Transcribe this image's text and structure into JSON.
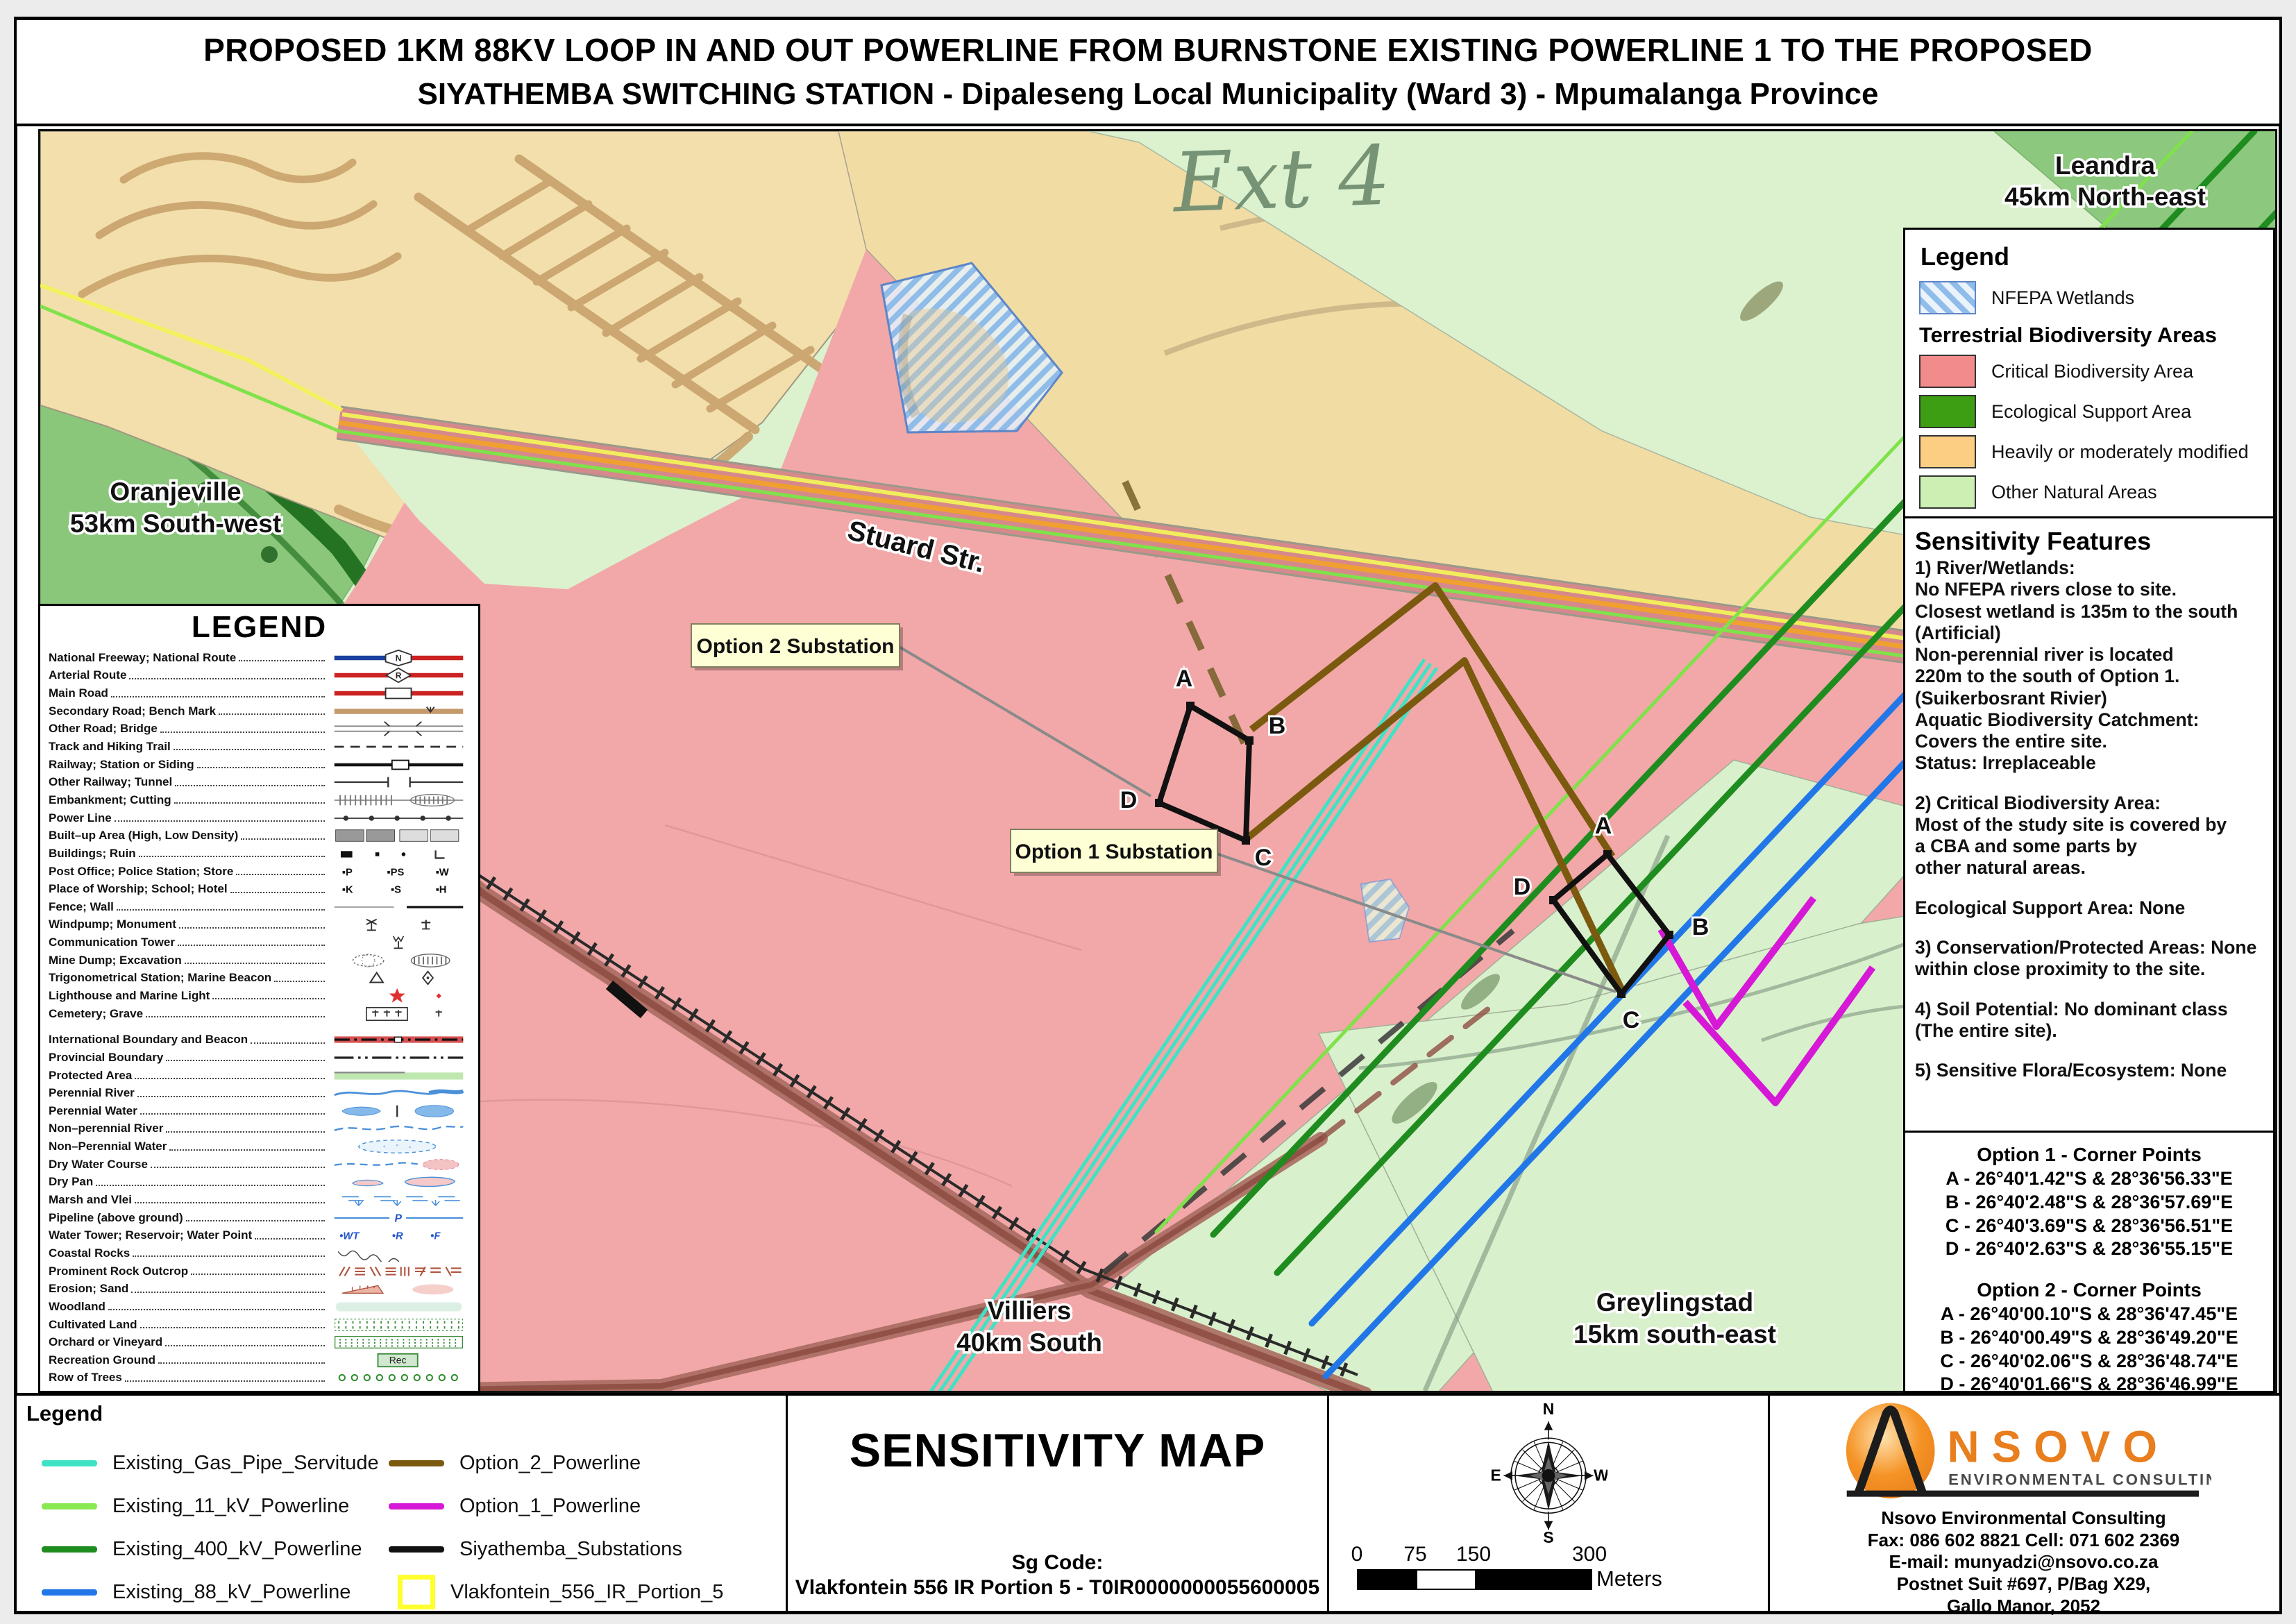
{
  "title": {
    "line1": "PROPOSED 1KM 88KV LOOP IN AND OUT POWERLINE FROM BURNSTONE EXISTING POWERLINE 1 TO THE PROPOSED",
    "line2": "SIYATHEMBA SWITCHING STATION - Dipaleseng Local Municipality (Ward 3) - Mpumalanga Province"
  },
  "map": {
    "labels": {
      "ext4": "Ext 4",
      "leandra": [
        "Leandra",
        "45km North-east"
      ],
      "oranjeville": [
        "Oranjeville",
        "53km South-west"
      ],
      "stuard": "Stuard Str.",
      "villiers": [
        "Villiers",
        "40km South"
      ],
      "greylingstad": [
        "Greylingstad",
        "15km south-east"
      ],
      "option2_box": "Option 2 Substation",
      "option1_box": "Option 1 Substation",
      "corners": [
        "A",
        "B",
        "C",
        "D"
      ]
    }
  },
  "right_legend": {
    "title": "Legend",
    "wetlands": "NFEPA Wetlands",
    "subtitle": "Terrestrial Biodiversity Areas",
    "items": [
      {
        "label": "Critical Biodiversity Area",
        "color": "#F28B8B"
      },
      {
        "label": "Ecological Support Area",
        "color": "#3D9E14"
      },
      {
        "label": "Heavily or moderately modified",
        "color": "#FBCE84"
      },
      {
        "label": "Other Natural Areas",
        "color": "#CDEFB4"
      }
    ]
  },
  "sensitivity": {
    "title": "Sensitivity Features",
    "lines": [
      "1) River/Wetlands:",
      "No NFEPA rivers close to site.",
      "Closest wetland is 135m to the south",
      "(Artificial)",
      "Non-perennial river is located",
      "220m to the south of Option 1.",
      "(Suikerbosrant Rivier)",
      "Aquatic Biodiversity Catchment:",
      "Covers the entire site.",
      "Status: Irreplaceable",
      "",
      "2) Critical Biodiversity Area:",
      "Most of the study site is covered by",
      "a CBA and some parts by",
      " other natural areas.",
      "",
      "Ecological Support Area: None",
      "",
      "3) Conservation/Protected Areas: None",
      "within close proximity to the site.",
      "",
      "4) Soil Potential: No dominant class",
      " (The entire site).",
      "",
      "5) Sensitive Flora/Ecosystem: None"
    ]
  },
  "corner_points": {
    "option1_title": "Option 1 - Corner Points",
    "option1": [
      "A -  26°40'1.42\"S  &  28°36'56.33\"E",
      "B -  26°40'2.48\"S  &  28°36'57.69\"E",
      "C -  26°40'3.69\"S  &  28°36'56.51\"E",
      "D -  26°40'2.63\"S  &  28°36'55.15\"E"
    ],
    "option2_title": "Option 2 - Corner Points",
    "option2": [
      "A -   26°40'00.10\"S  &   28°36'47.45\"E",
      "B -   26°40'00.49\"S  &   28°36'49.20\"E",
      "C -   26°40'02.06\"S  &   28°36'48.74\"E",
      "D -   26°40'01.66\"S  &   28°36'46.99\"E"
    ]
  },
  "map_legend": {
    "title": "LEGEND",
    "items": [
      {
        "label": "National Freeway; National Route",
        "sym": "freeway"
      },
      {
        "label": "Arterial Route",
        "sym": "arterial"
      },
      {
        "label": "Main Road",
        "sym": "main"
      },
      {
        "label": "Secondary Road; Bench Mark",
        "sym": "secondary"
      },
      {
        "label": "Other Road; Bridge",
        "sym": "other_road"
      },
      {
        "label": "Track and Hiking Trail",
        "sym": "track"
      },
      {
        "label": "Railway; Station or Siding",
        "sym": "railway"
      },
      {
        "label": "Other Railway; Tunnel",
        "sym": "other_railway"
      },
      {
        "label": "Embankment; Cutting",
        "sym": "embankment"
      },
      {
        "label": "Power Line",
        "sym": "powerline"
      },
      {
        "label": "Built–up Area (High, Low Density)",
        "sym": "builtup"
      },
      {
        "label": "Buildings; Ruin",
        "sym": "buildings"
      },
      {
        "label": "Post Office; Police Station; Store",
        "sym": "po"
      },
      {
        "label": "Place of Worship; School; Hotel",
        "sym": "worship"
      },
      {
        "label": "Fence; Wall",
        "sym": "fence"
      },
      {
        "label": "Windpump; Monument",
        "sym": "windpump"
      },
      {
        "label": "Communication Tower",
        "sym": "tower"
      },
      {
        "label": "Mine Dump; Excavation",
        "sym": "minedump"
      },
      {
        "label": "Trigonometrical Station; Marine Beacon",
        "sym": "trig"
      },
      {
        "label": "Lighthouse and Marine Light",
        "sym": "lighthouse"
      },
      {
        "label": "Cemetery; Grave",
        "sym": "cemetery"
      },
      {
        "label": "International Boundary and Beacon",
        "sym": "intl",
        "gapBefore": true
      },
      {
        "label": "Provincial Boundary",
        "sym": "prov"
      },
      {
        "label": "Protected Area",
        "sym": "protected"
      },
      {
        "label": "Perennial River",
        "sym": "per_river"
      },
      {
        "label": "Perennial Water",
        "sym": "per_water"
      },
      {
        "label": "Non–perennial River",
        "sym": "nonper_river"
      },
      {
        "label": "Non–Perennial Water",
        "sym": "nonper_water"
      },
      {
        "label": "Dry Water Course",
        "sym": "dry_course"
      },
      {
        "label": "Dry Pan",
        "sym": "dry_pan"
      },
      {
        "label": "Marsh and Vlei",
        "sym": "marsh"
      },
      {
        "label": "Pipeline (above ground)",
        "sym": "pipeline"
      },
      {
        "label": "Water Tower; Reservoir; Water Point",
        "sym": "watertower"
      },
      {
        "label": "Coastal Rocks",
        "sym": "coastal"
      },
      {
        "label": "Prominent Rock Outcrop",
        "sym": "rock"
      },
      {
        "label": "Erosion; Sand",
        "sym": "erosion"
      },
      {
        "label": "Woodland",
        "sym": "woodland"
      },
      {
        "label": "Cultivated Land",
        "sym": "cultivated"
      },
      {
        "label": "Orchard or Vineyard",
        "sym": "orchard"
      },
      {
        "label": "Recreation Ground",
        "sym": "recreation"
      },
      {
        "label": "Row of Trees",
        "sym": "trees"
      }
    ]
  },
  "bottom": {
    "legend_title": "Legend",
    "lines": [
      {
        "label": "Existing_Gas_Pipe_Servitude",
        "color": "#3FE2C5",
        "type": "line"
      },
      {
        "label": "Existing_11_kV_Powerline",
        "color": "#8AE852",
        "type": "line"
      },
      {
        "label": "Existing_400_kV_Powerline",
        "color": "#1F8C1F",
        "type": "line"
      },
      {
        "label": "Existing_88_kV_Powerline",
        "color": "#2277E8",
        "type": "line"
      },
      {
        "label": "Option_2_Powerline",
        "color": "#7B5A10",
        "type": "line"
      },
      {
        "label": "Option_1_Powerline",
        "color": "#D619D6",
        "type": "line"
      },
      {
        "label": "Siyathemba_Substations",
        "color": "#111111",
        "type": "line"
      },
      {
        "label": "Vlakfontein_556_IR_Portion_5",
        "color": "#FFFF2E",
        "type": "box"
      }
    ],
    "map_type": "SENSITIVITY MAP",
    "sg_label": "Sg Code:",
    "sg_value": "Vlakfontein 556 IR Portion 5 - T0IR0000000055600005",
    "scale": {
      "ticks": [
        "0",
        "75",
        "150",
        "300"
      ],
      "unit": "Meters"
    },
    "compass": [
      "N",
      "S",
      "E",
      "W"
    ],
    "nsovo": {
      "brand": "NSOVO",
      "brand_sub": "ENVIRONMENTAL CONSULTING",
      "contact": [
        "Nsovo Environmental Consulting",
        "Fax: 086 602 8821 Cell: 071 602 2369",
        "E-mail: munyadzi@nsovo.co.za",
        "Postnet Suit #697, P/Bag X29,",
        "Gallo Manor, 2052"
      ]
    }
  }
}
